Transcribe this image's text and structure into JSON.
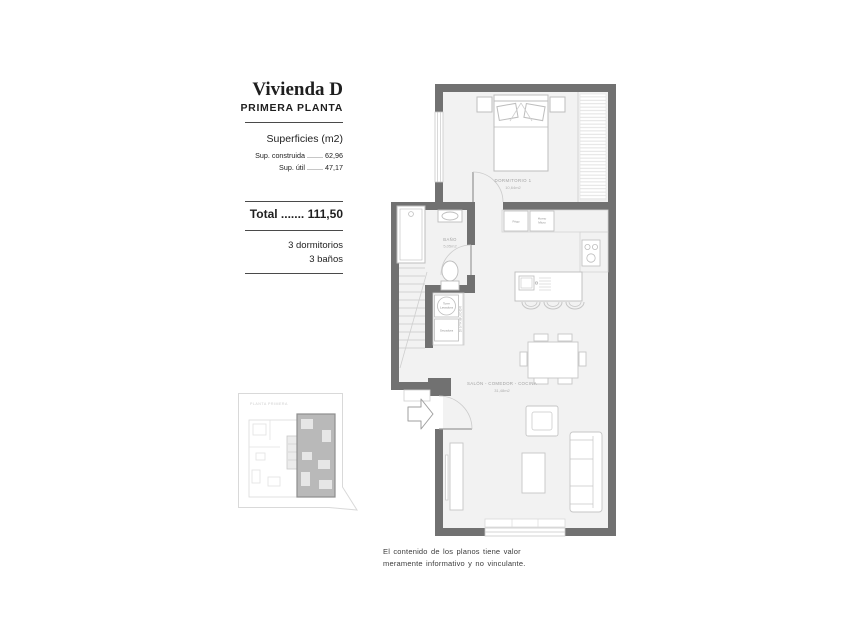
{
  "panel": {
    "title": "Vivienda D",
    "subtitle": "PRIMERA PLANTA",
    "surfaces_heading": "Superficies (m2)",
    "surface_rows": [
      {
        "label": "Sup. construida",
        "dots": "........",
        "value": "62,96"
      },
      {
        "label": "Sup. útil",
        "dots": "........",
        "value": "47,17"
      }
    ],
    "total": {
      "label": "Total",
      "dots": ".......",
      "value": "111,50"
    },
    "features": [
      "3 dormitorios",
      "3 baños"
    ]
  },
  "plan": {
    "rooms": {
      "bedroom": {
        "name": "DORMITORIO 1",
        "area": "10,64m2"
      },
      "bathroom": {
        "name": "BAÑO",
        "area": "5,05m2"
      },
      "living": {
        "name": "SALÓN - COMEDOR - COCINA",
        "area": "31,48m2"
      }
    },
    "labels": {
      "fridge": "Frigo",
      "oven_line1": "Horno",
      "oven_line2": "Micro",
      "washer_line1": "Torre",
      "washer_line2": "Lavadora",
      "dryer": "Secadora",
      "hall": "DISTRIBUIDOR"
    }
  },
  "keyplan": {
    "caption": "PLANTA PRIMERA"
  },
  "disclaimer": {
    "line1": "El contenido de los planos tiene valor",
    "line2": "meramente informativo y no vinculante."
  },
  "colors": {
    "wall": "#717171",
    "floor": "#f2f2f2",
    "furniture_line": "#bdbdbd",
    "plan_text": "#a3a3a3",
    "keyplan_highlight": "#b9b9b9"
  }
}
